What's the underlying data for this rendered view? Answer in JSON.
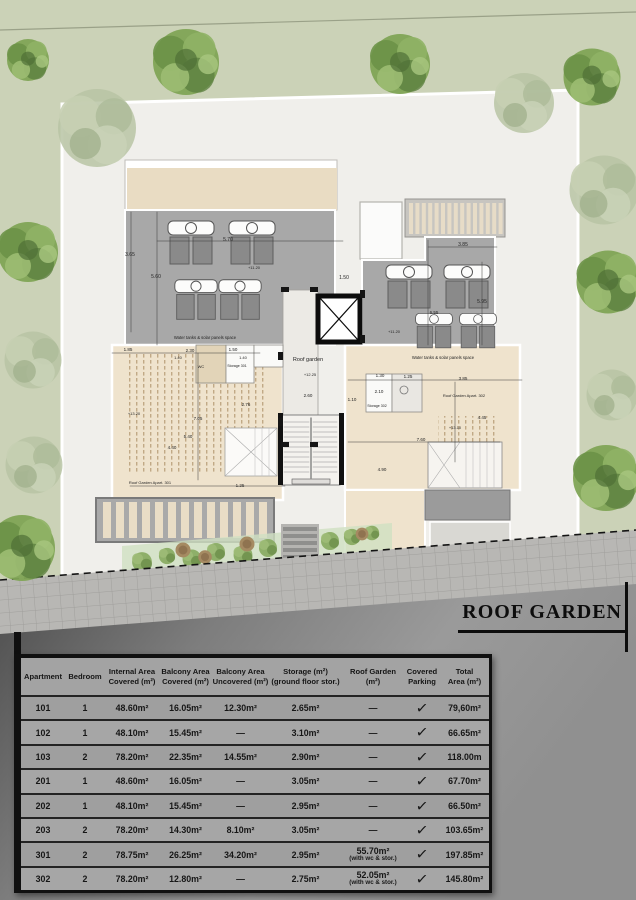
{
  "title": "ROOF GARDEN",
  "colors": {
    "background_green": "#cbd2b7",
    "site_white": "#f0efeb",
    "terrace_gray": "#a8a8a8",
    "roof_beige": "#efe3cd",
    "road_dark": "#4f4f4f",
    "table_gray": "#9f9f9f",
    "tree_green": "#7fa455"
  },
  "plan": {
    "labels": [
      {
        "x": 130,
        "y": 256,
        "t": "3.65",
        "s": 5
      },
      {
        "x": 156,
        "y": 278,
        "t": "5.60",
        "s": 5
      },
      {
        "x": 228,
        "y": 241,
        "t": "5.70",
        "s": 5
      },
      {
        "x": 254,
        "y": 269,
        "t": "+11.20",
        "s": 4
      },
      {
        "x": 344,
        "y": 279,
        "t": "1.50",
        "s": 5
      },
      {
        "x": 463,
        "y": 246,
        "t": "3.85",
        "s": 5
      },
      {
        "x": 482,
        "y": 303,
        "t": "5.95",
        "s": 5
      },
      {
        "x": 434,
        "y": 314,
        "t": "6.55",
        "s": 4.5
      },
      {
        "x": 394,
        "y": 333,
        "t": "+11.20",
        "s": 4
      },
      {
        "x": 205,
        "y": 339,
        "t": "Water tanks & solar panels space",
        "s": 4.2
      },
      {
        "x": 443,
        "y": 359,
        "t": "Water tanks & solar panels space",
        "s": 4.2
      },
      {
        "x": 128,
        "y": 351,
        "t": "1.85",
        "s": 4.5
      },
      {
        "x": 190,
        "y": 352,
        "t": "2.30",
        "s": 4.5
      },
      {
        "x": 233,
        "y": 351,
        "t": "1.50",
        "s": 4.5
      },
      {
        "x": 178,
        "y": 359,
        "t": "1.40",
        "s": 4
      },
      {
        "x": 243,
        "y": 359,
        "t": "1.40",
        "s": 4
      },
      {
        "x": 201,
        "y": 368,
        "t": "WC",
        "s": 4
      },
      {
        "x": 237,
        "y": 367,
        "t": "Storage 301",
        "s": 3.6
      },
      {
        "x": 308,
        "y": 361,
        "t": "Roof garden",
        "s": 5.5
      },
      {
        "x": 310,
        "y": 376,
        "t": "+12.25",
        "s": 4
      },
      {
        "x": 246,
        "y": 406,
        "t": "2.76",
        "s": 4.5
      },
      {
        "x": 198,
        "y": 420,
        "t": "7.05",
        "s": 4.5
      },
      {
        "x": 188,
        "y": 438,
        "t": "5.40",
        "s": 4.5
      },
      {
        "x": 172,
        "y": 449,
        "t": "4.40",
        "s": 4.5
      },
      {
        "x": 134,
        "y": 415,
        "t": "+13.20",
        "s": 4
      },
      {
        "x": 150,
        "y": 484,
        "t": "Roof Garden Apart. 301",
        "s": 4
      },
      {
        "x": 240,
        "y": 487,
        "t": "1.25",
        "s": 4.5
      },
      {
        "x": 308,
        "y": 397,
        "t": "2.60",
        "s": 4.5
      },
      {
        "x": 352,
        "y": 401,
        "t": "1.10",
        "s": 4.5
      },
      {
        "x": 380,
        "y": 377,
        "t": "1.30",
        "s": 4.5
      },
      {
        "x": 408,
        "y": 378,
        "t": "1.25",
        "s": 4.5
      },
      {
        "x": 463,
        "y": 380,
        "t": "3.85",
        "s": 4.5
      },
      {
        "x": 379,
        "y": 393,
        "t": "2.10",
        "s": 4.5
      },
      {
        "x": 377,
        "y": 407,
        "t": "Storage 302",
        "s": 3.6
      },
      {
        "x": 464,
        "y": 397,
        "t": "Roof Garden Apart. 302",
        "s": 4
      },
      {
        "x": 482,
        "y": 419,
        "t": "4.45",
        "s": 4.5
      },
      {
        "x": 455,
        "y": 429,
        "t": "+13.10",
        "s": 4
      },
      {
        "x": 421,
        "y": 441,
        "t": "7.60",
        "s": 4.5
      },
      {
        "x": 382,
        "y": 471,
        "t": "4.90",
        "s": 4.5
      }
    ]
  },
  "table": {
    "headers": [
      "Apartment",
      "Bedroom",
      "Internal Area\nCovered (m²)",
      "Balcony Area\nCovered (m²)",
      "Balcony Area\nUncovered (m²)",
      "Storage (m²)\n(ground floor stor.)",
      "Roof Garden\n(m²)",
      "Covered\nParking",
      "Total\nArea (m²)"
    ],
    "rows": [
      {
        "apartment": "101",
        "bedroom": "1",
        "internal": "48.60m²",
        "balcony_covered": "16.05m²",
        "balcony_uncovered": "12.30m²",
        "storage": "2.65m²",
        "roof_garden": "—",
        "roof_garden_note": "",
        "parking": "✓",
        "total": "79,60m²"
      },
      {
        "apartment": "102",
        "bedroom": "1",
        "internal": "48.10m²",
        "balcony_covered": "15.45m²",
        "balcony_uncovered": "—",
        "storage": "3.10m²",
        "roof_garden": "—",
        "roof_garden_note": "",
        "parking": "✓",
        "total": "66.65m²"
      },
      {
        "apartment": "103",
        "bedroom": "2",
        "internal": "78.20m²",
        "balcony_covered": "22.35m²",
        "balcony_uncovered": "14.55m²",
        "storage": "2.90m²",
        "roof_garden": "—",
        "roof_garden_note": "",
        "parking": "✓",
        "total": "118.00m"
      },
      {
        "apartment": "201",
        "bedroom": "1",
        "internal": "48.60m²",
        "balcony_covered": "16.05m²",
        "balcony_uncovered": "—",
        "storage": "3.05m²",
        "roof_garden": "—",
        "roof_garden_note": "",
        "parking": "✓",
        "total": "67.70m²"
      },
      {
        "apartment": "202",
        "bedroom": "1",
        "internal": "48.10m²",
        "balcony_covered": "15.45m²",
        "balcony_uncovered": "—",
        "storage": "2.95m²",
        "roof_garden": "—",
        "roof_garden_note": "",
        "parking": "✓",
        "total": "66.50m²"
      },
      {
        "apartment": "203",
        "bedroom": "2",
        "internal": "78.20m²",
        "balcony_covered": "14.30m²",
        "balcony_uncovered": "8.10m²",
        "storage": "3.05m²",
        "roof_garden": "—",
        "roof_garden_note": "",
        "parking": "✓",
        "total": "103.65m²"
      },
      {
        "apartment": "301",
        "bedroom": "2",
        "internal": "78.75m²",
        "balcony_covered": "26.25m²",
        "balcony_uncovered": "34.20m²",
        "storage": "2.95m²",
        "roof_garden": "55.70m²",
        "roof_garden_note": "(with wc & stor.)",
        "parking": "✓",
        "total": "197.85m²"
      },
      {
        "apartment": "302",
        "bedroom": "2",
        "internal": "78.20m²",
        "balcony_covered": "12.80m²",
        "balcony_uncovered": "—",
        "storage": "2.75m²",
        "roof_garden": "52.05m²",
        "roof_garden_note": "(with wc & stor.)",
        "parking": "✓",
        "total": "145.80m²"
      }
    ]
  }
}
